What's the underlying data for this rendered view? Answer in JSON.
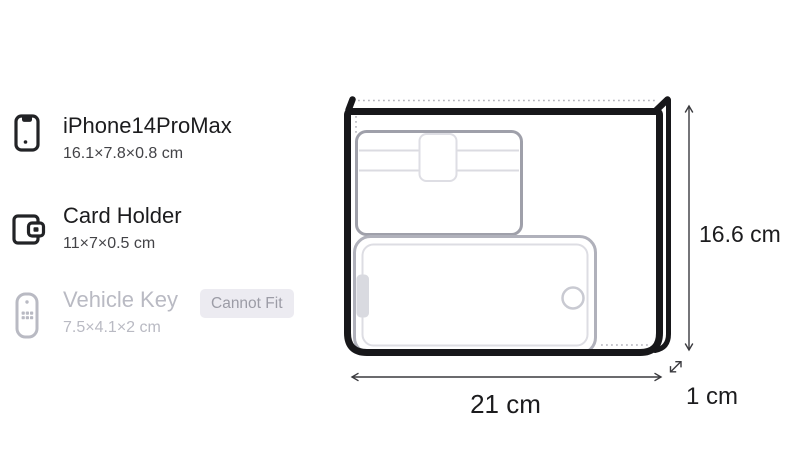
{
  "items": [
    {
      "name": "iPhone14ProMax",
      "dimensions": "16.1×7.8×0.8 cm",
      "icon": "smartphone-icon",
      "status": "fits"
    },
    {
      "name": "Card Holder",
      "dimensions": "11×7×0.5 cm",
      "icon": "wallet-icon",
      "status": "fits"
    },
    {
      "name": "Vehicle Key",
      "dimensions": "7.5×4.1×2 cm",
      "icon": "car-key-remote-icon",
      "status": "cannot-fit",
      "badge": "Cannot Fit"
    }
  ],
  "container": {
    "width_label": "21 cm",
    "height_label": "16.6 cm",
    "depth_label": "1 cm"
  },
  "colors": {
    "text_primary": "#1c1c1e",
    "text_secondary": "#434347",
    "text_disabled": "#b9bac3",
    "badge_bg": "#ecebf1",
    "badge_text": "#9c9ca6",
    "bag_outline": "#17171a",
    "item_outline_gray": "#a0a1ab"
  }
}
